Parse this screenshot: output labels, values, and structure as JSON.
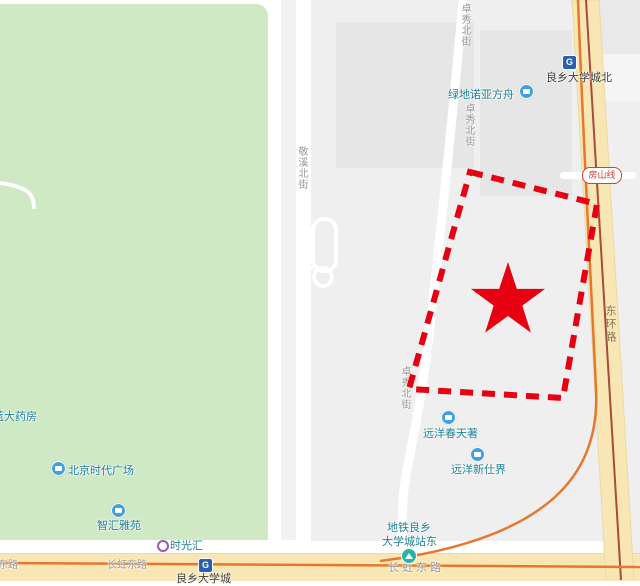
{
  "map": {
    "park_color": "#cfe9c5",
    "accent_red": "#e60012",
    "road_tan": "#f8e7b5",
    "poi_text_color": "#1f7f95",
    "road_label_color": "#979797",
    "metro_track_color": "#a84a3c",
    "orange_route_color": "#e5782e",
    "poi_icon_color": "#41a0dd",
    "subway_icon_color": "#2b5fae"
  },
  "icons": {
    "subway_logo_glyph": "G"
  },
  "stations": {
    "line_badge": "房山线",
    "north_station": "良乡大学城北",
    "main_station": "良乡大学城",
    "east_exit_line1": "地铁良乡",
    "east_exit_line2": "大学城站东"
  },
  "roads": {
    "zhuoxiu_1": "卓秀北街",
    "zhuoxiu_2": "卓秀北街",
    "zhuoxiu_3": "卓秀北街",
    "jingxi": "敬溪北街",
    "donghuan": "东环路",
    "changhong_1": "长虹东路",
    "changhong_2": "长虹东路",
    "changhong_3": "长虹东路"
  },
  "pois": {
    "pharmacy": "蓝大药房",
    "times_square": "北京时代广场",
    "zhihui_yayuan": "智汇雅苑",
    "shiguanghui": "时光汇",
    "greenland_noah": "绿地诺亚方舟",
    "sino_ocean_spring": "远洋春天著",
    "sino_ocean_new": "远洋新仕界"
  }
}
